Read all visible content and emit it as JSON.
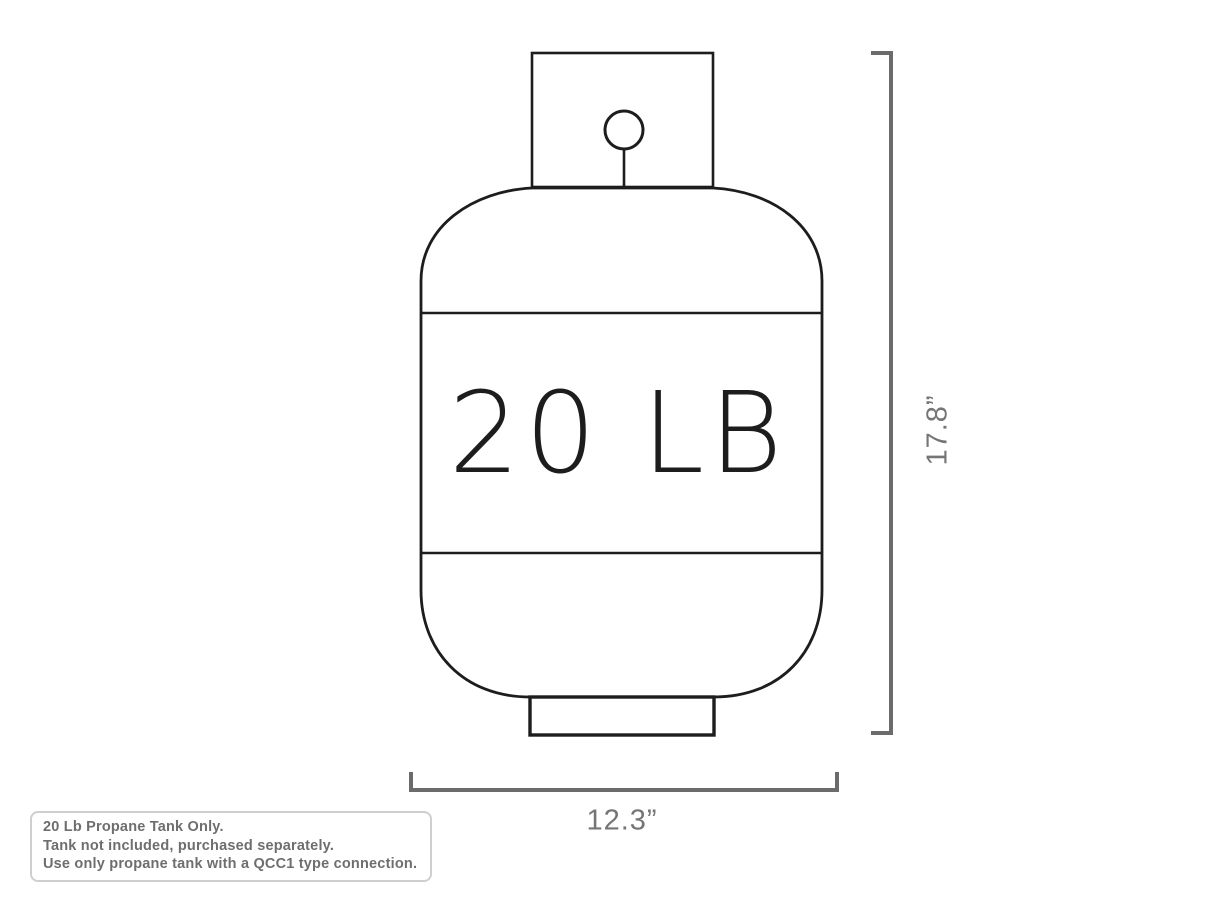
{
  "diagram": {
    "title": "propane tank dimension diagram",
    "tank_label": "20 LB",
    "height_dimension": "17.8”",
    "width_dimension": "12.3”",
    "colors": {
      "tank_outline": "#1d1d1d",
      "dimension_lines": "#6b6b6b",
      "dimension_text": "#757575",
      "note_text": "#6e6e6e",
      "note_border": "#cfcfcf",
      "background": "#ffffff"
    }
  },
  "note": {
    "lines": [
      "20 Lb Propane Tank Only.",
      "Tank not included, purchased separately.",
      "Use only propane tank with a QCC1 type connection."
    ]
  }
}
